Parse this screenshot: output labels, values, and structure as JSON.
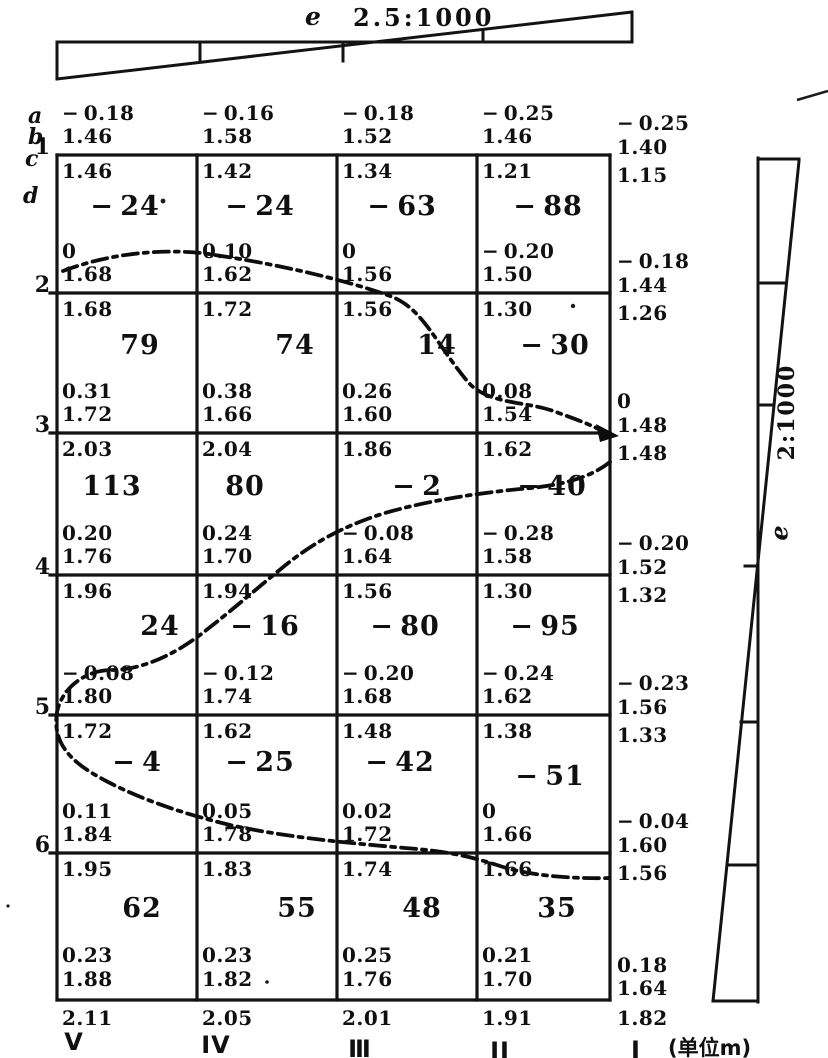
{
  "figure": {
    "top_indicator": {
      "e_label": "e",
      "scale": "2.5:1000"
    },
    "right_indicator": {
      "e_label": "e",
      "scale": "2:1000"
    },
    "units_label": "(单位m)",
    "axis_letter_labels": [
      "a",
      "b",
      "c",
      "d"
    ],
    "row_numbers": [
      "1",
      "2",
      "3",
      "4",
      "5",
      "6"
    ],
    "column_labels": [
      "V",
      "IV",
      "Ⅲ",
      "II",
      "I"
    ]
  },
  "grid": {
    "lines": [
      {
        "cols": [
          {
            "a": "-0.18",
            "b": "1.46",
            "c": "1.46"
          },
          {
            "a": "-0.16",
            "b": "1.58",
            "c": "1.42"
          },
          {
            "a": "-0.18",
            "b": "1.52",
            "c": "1.34"
          },
          {
            "a": "-0.25",
            "b": "1.46",
            "c": "1.21"
          },
          {
            "a": "-0.25",
            "b": "1.40",
            "c": "1.15"
          }
        ]
      },
      {
        "cols": [
          {
            "a": "0",
            "b": "1.68",
            "c": "1.68"
          },
          {
            "a": "0.10",
            "b": "1.62",
            "c": "1.72"
          },
          {
            "a": "0",
            "b": "1.56",
            "c": "1.56"
          },
          {
            "a": "-0.20",
            "b": "1.50",
            "c": "1.30"
          },
          {
            "a": "-0.18",
            "b": "1.44",
            "c": "1.26"
          }
        ]
      },
      {
        "cols": [
          {
            "a": "0.31",
            "b": "1.72",
            "c": "2.03"
          },
          {
            "a": "0.38",
            "b": "1.66",
            "c": "2.04"
          },
          {
            "a": "0.26",
            "b": "1.60",
            "c": "1.86"
          },
          {
            "a": "0.08",
            "b": "1.54",
            "c": "1.62"
          },
          {
            "a": "0",
            "b": "1.48",
            "c": "1.48"
          }
        ]
      },
      {
        "cols": [
          {
            "a": "0.20",
            "b": "1.76",
            "c": "1.96"
          },
          {
            "a": "0.24",
            "b": "1.70",
            "c": "1.94"
          },
          {
            "a": "-0.08",
            "b": "1.64",
            "c": "1.56"
          },
          {
            "a": "-0.28",
            "b": "1.58",
            "c": "1.30"
          },
          {
            "a": "-0.20",
            "b": "1.52",
            "c": "1.32"
          }
        ]
      },
      {
        "cols": [
          {
            "a": "-0.08",
            "b": "1.80",
            "c": "1.72"
          },
          {
            "a": "-0.12",
            "b": "1.74",
            "c": "1.62"
          },
          {
            "a": "-0.20",
            "b": "1.68",
            "c": "1.48"
          },
          {
            "a": "-0.24",
            "b": "1.62",
            "c": "1.38"
          },
          {
            "a": "-0.23",
            "b": "1.56",
            "c": "1.33"
          }
        ]
      },
      {
        "cols": [
          {
            "a": "0.11",
            "b": "1.84",
            "c": "1.95"
          },
          {
            "a": "0.05",
            "b": "1.78",
            "c": "1.83"
          },
          {
            "a": "0.02",
            "b": "1.72",
            "c": "1.74"
          },
          {
            "a": "0",
            "b": "1.66",
            "c": "1.66"
          },
          {
            "a": "-0.04",
            "b": "1.60",
            "c": "1.56"
          }
        ]
      },
      {
        "cols": [
          {
            "a": "0.23",
            "b": "1.88",
            "c": "2.11"
          },
          {
            "a": "0.23",
            "b": "1.82",
            "c": "2.05"
          },
          {
            "a": "0.25",
            "b": "1.76",
            "c": "2.01"
          },
          {
            "a": "0.21",
            "b": "1.70",
            "c": "1.91"
          },
          {
            "a": "0.18",
            "b": "1.64",
            "c": "1.82"
          }
        ]
      }
    ],
    "cells": [
      [
        "-24",
        "-24",
        "-63",
        "-88"
      ],
      [
        "79",
        "74",
        "14",
        "-30"
      ],
      [
        "113",
        "80",
        "-2",
        "-40"
      ],
      [
        "24",
        "-16",
        "-80",
        "-95"
      ],
      [
        "-4",
        "-25",
        "-42",
        "-51"
      ],
      [
        "62",
        "55",
        "48",
        "35"
      ]
    ]
  }
}
